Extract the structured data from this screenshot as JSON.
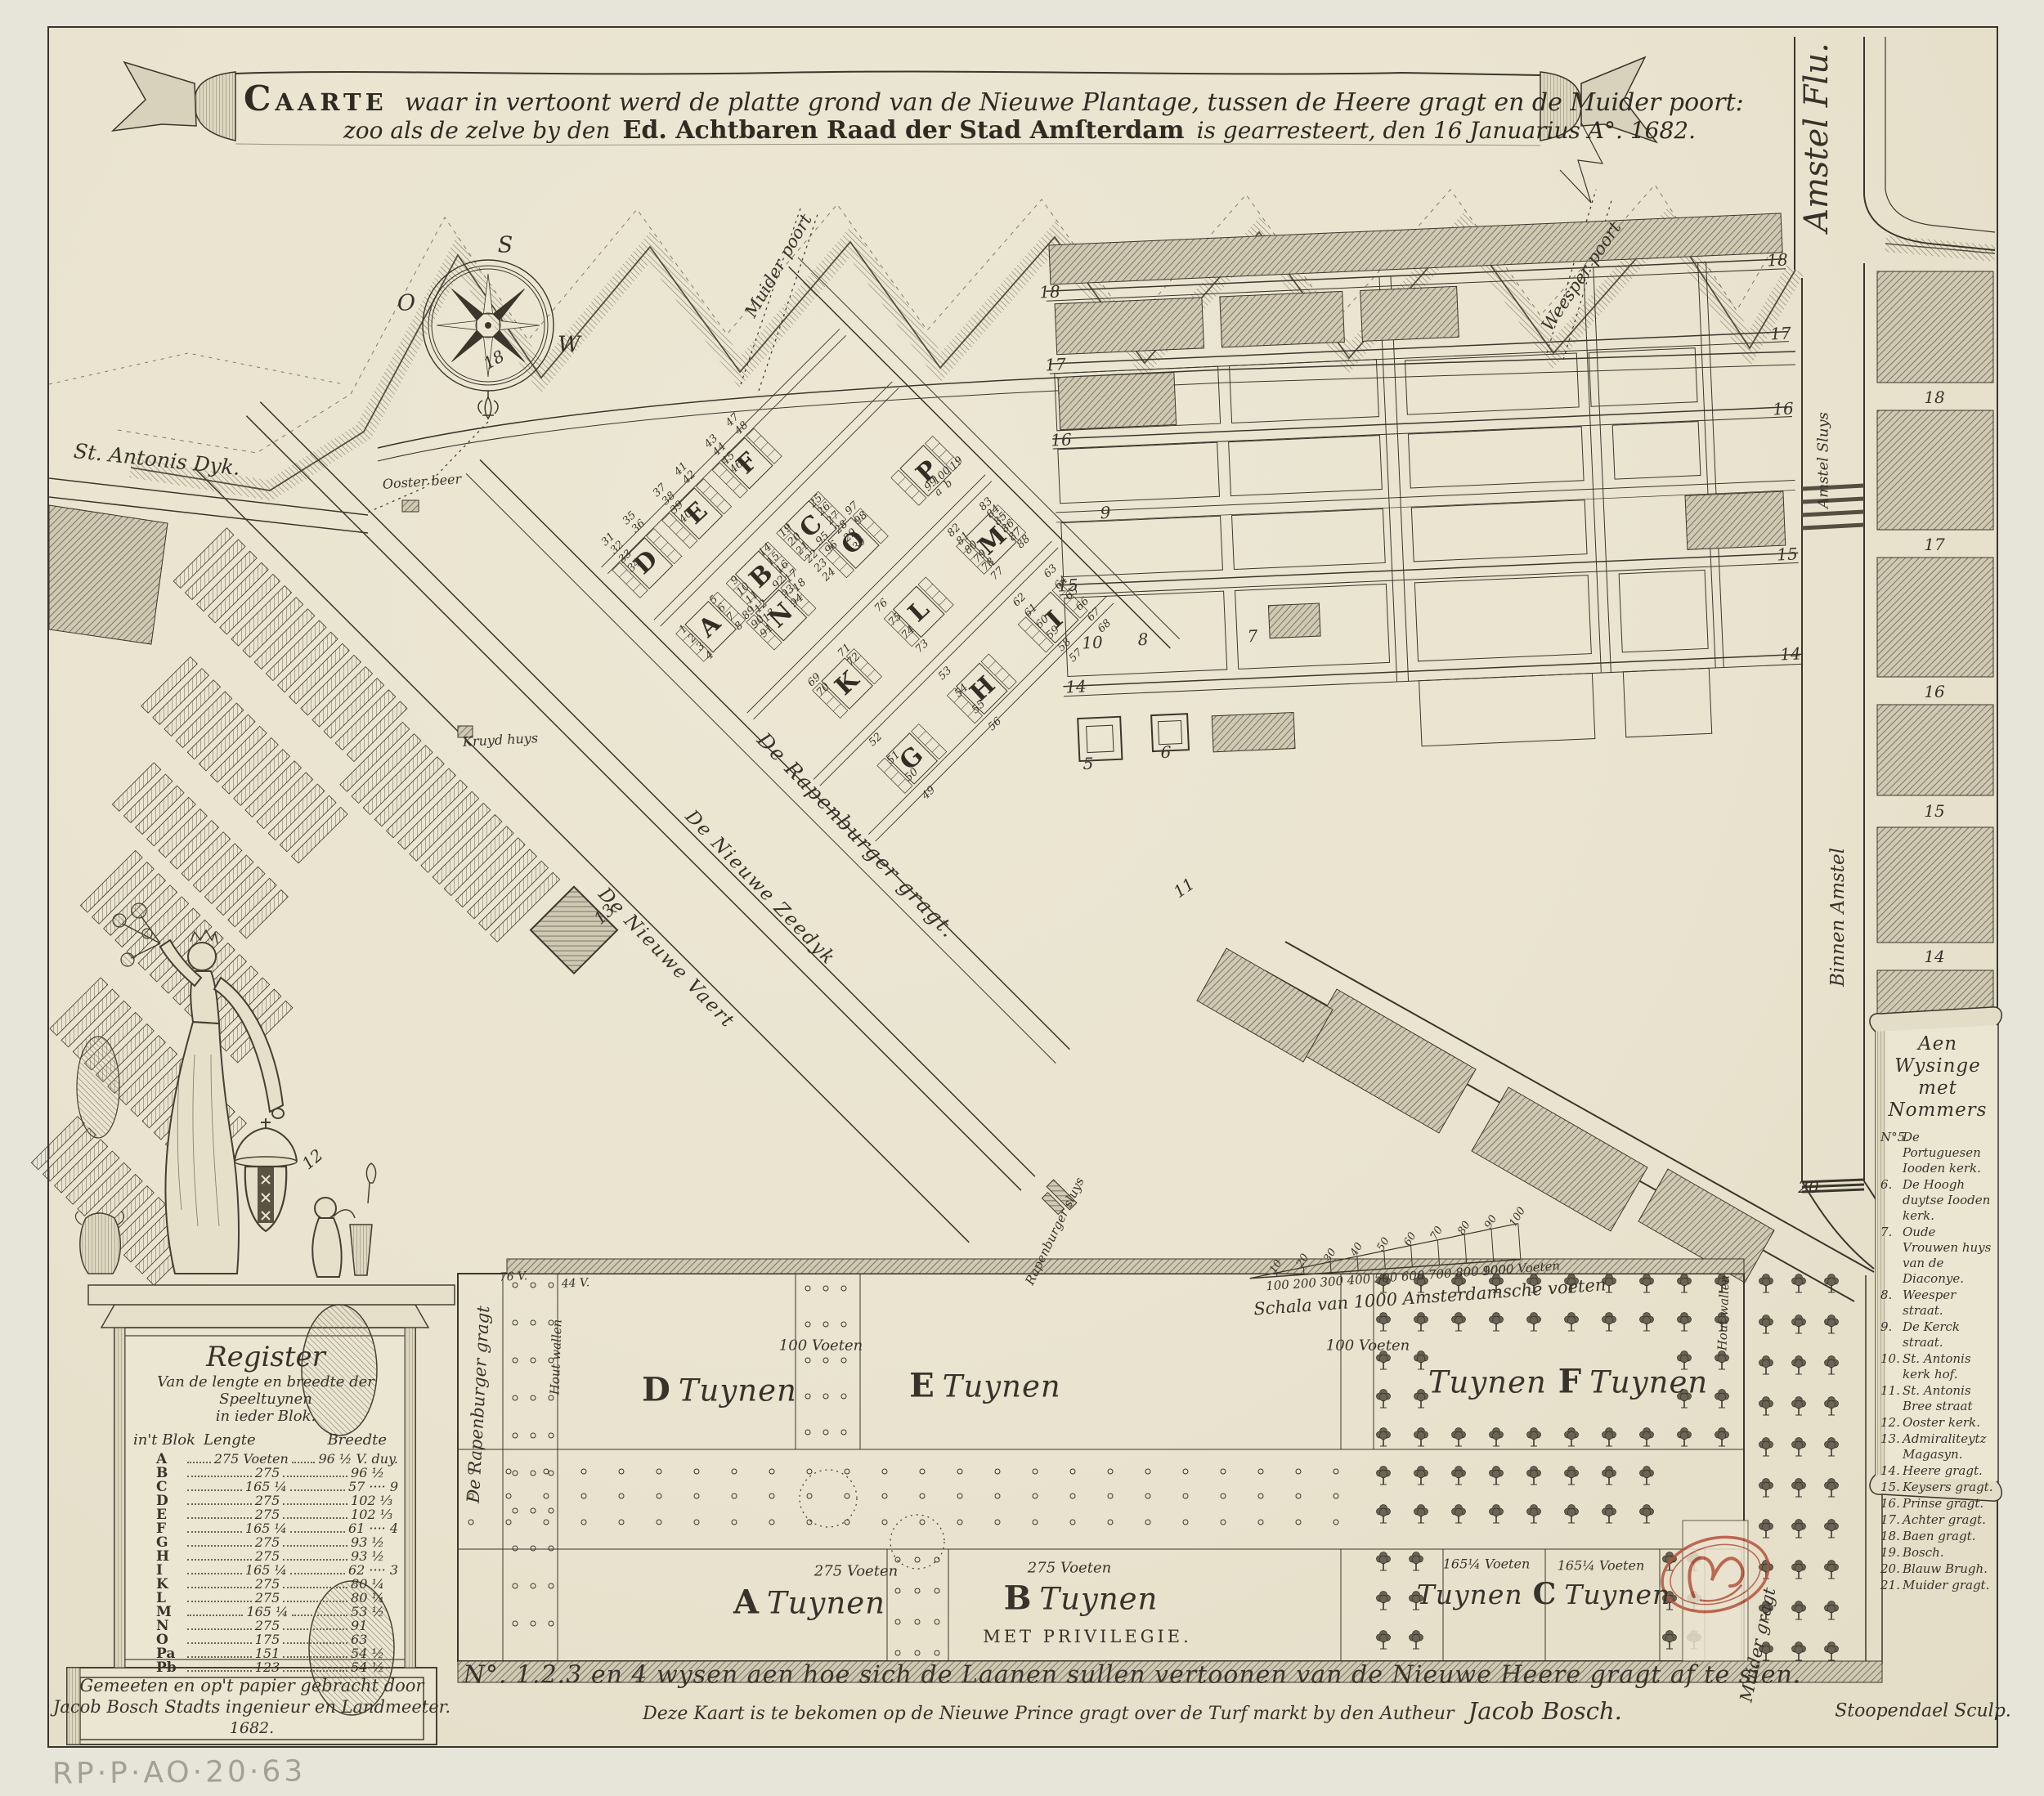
{
  "banner": {
    "l1a": "Caarte",
    "l1b": "waar in vertoont werd de platte grond van de Nieuwe Plantage, tussen de Heere gragt en de Muider poort:",
    "l2a": "zoo als de zelve by den",
    "l2b": "Ed. Achtbaren Raad der Stad Amſterdam",
    "l2c": "is gearresteert, den 16 Januarius A°. 1682."
  },
  "compass": {
    "s": "S",
    "o": "O",
    "w": "W"
  },
  "labels": {
    "amstel_flu": "Amstel Flu.",
    "st_antonis_dyk": "St. Antonis Dyk.",
    "ooster_beer": "Ooster beer",
    "muider_poort": "Muider poort",
    "weesper_poort": "Weesper poort",
    "amstel_sluys": "Amstel Sluys",
    "binnen_amstel": "Binnen Amstel",
    "kruyd_huys": "Kruyd huys",
    "rapenburger_gragt": "De Rapenburger gragt.",
    "nieuwe_zeedyk": "De Nieuwe Zeedyk",
    "nieuwe_vaert": "De Nieuwe Vaert",
    "rapenburger_sluys": "Rapenburger sluys",
    "rapenburger_vert": "De Rapenburger gragt",
    "muider_gragt": "Muider gragt",
    "hout_wallen_left": "Hout wallen",
    "hout_wallen_right": "Hout wallen"
  },
  "gardens": {
    "v100a": "100 Voeten",
    "v100b": "100 Voeten",
    "v275a": "275 Voeten",
    "v275b": "275 Voeten",
    "v165a": "165¼ Voeten",
    "v165b": "165¼ Voeten",
    "v76": "76 V.",
    "v44": "44 V.",
    "d_l": "D",
    "d_w": "Tuynen",
    "e_l": "E",
    "e_w": "Tuynen",
    "f_pre": "Tuynen",
    "f_l": "F",
    "f_w": "Tuynen",
    "a_l": "A",
    "a_w": "Tuynen",
    "b_l": "B",
    "b_w": "Tuynen",
    "privilege": "MET PRIVILEGIE.",
    "c_pre": "Tuynen",
    "c_l": "C",
    "c_w": "Tuynen"
  },
  "scalebar": {
    "caption": "Schala van 1000 Amsterdamsche voeten",
    "bottom": [
      "100",
      "200",
      "300",
      "400",
      "500",
      "600",
      "700",
      "800",
      "900",
      "1000 Voeten"
    ],
    "top": [
      "10",
      "20",
      "30",
      "40",
      "50",
      "60",
      "70",
      "80",
      "90",
      "100"
    ]
  },
  "map": {
    "block_letters": [
      [
        "A",
        868,
        766
      ],
      [
        "B",
        931,
        705
      ],
      [
        "C",
        992,
        644
      ],
      [
        "D",
        790,
        688
      ],
      [
        "E",
        852,
        628
      ],
      [
        "F",
        914,
        567
      ],
      [
        "G",
        1115,
        928
      ],
      [
        "H",
        1202,
        843
      ],
      [
        "I",
        1290,
        758
      ],
      [
        "K",
        1036,
        836
      ],
      [
        "L",
        1124,
        748
      ],
      [
        "M",
        1214,
        662
      ],
      [
        "N",
        955,
        753
      ],
      [
        "O",
        1044,
        664
      ],
      [
        "P",
        1134,
        577
      ]
    ],
    "ref_numbers": [
      [
        "18",
        1284,
        357,
        -3
      ],
      [
        "17",
        1291,
        446,
        -3
      ],
      [
        "16",
        1298,
        538,
        -3
      ],
      [
        "15",
        1306,
        716,
        -3
      ],
      [
        "14",
        1316,
        840,
        -3
      ],
      [
        "18",
        2174,
        318,
        -3
      ],
      [
        "17",
        2178,
        408,
        -3
      ],
      [
        "16",
        2181,
        500,
        -3
      ],
      [
        "15",
        2186,
        678,
        -3
      ],
      [
        "14",
        2190,
        800,
        -3
      ],
      [
        "18",
        2366,
        486,
        0
      ],
      [
        "17",
        2366,
        666,
        0
      ],
      [
        "16",
        2366,
        846,
        0
      ],
      [
        "15",
        2366,
        992,
        0
      ],
      [
        "14",
        2366,
        1170,
        0
      ],
      [
        "9",
        1352,
        627,
        -3
      ],
      [
        "10",
        1336,
        786,
        -3
      ],
      [
        "8",
        1398,
        782,
        -3
      ],
      [
        "7",
        1532,
        778,
        -3
      ],
      [
        "11",
        1448,
        1086,
        -35
      ],
      [
        "12",
        382,
        1418,
        -40
      ],
      [
        "13",
        739,
        1118,
        -42
      ],
      [
        "5",
        1331,
        934,
        0
      ],
      [
        "6",
        1426,
        920,
        0
      ],
      [
        "20",
        2212,
        1452,
        0
      ],
      [
        "18",
        604,
        440,
        -30
      ]
    ],
    "plot_numbers": [
      [
        "83",
        1206,
        617
      ],
      [
        "84",
        1215,
        626
      ],
      [
        "85",
        1224,
        635
      ],
      [
        "86",
        1233,
        644
      ],
      [
        "87",
        1242,
        654
      ],
      [
        "88",
        1252,
        663
      ],
      [
        "82",
        1167,
        649
      ],
      [
        "81",
        1178,
        659
      ],
      [
        "80",
        1188,
        670
      ],
      [
        "79",
        1199,
        681
      ],
      [
        "78",
        1209,
        691
      ],
      [
        "77",
        1220,
        702
      ],
      [
        "63",
        1285,
        699
      ],
      [
        "64",
        1298,
        713
      ],
      [
        "65",
        1311,
        726
      ],
      [
        "66",
        1324,
        739
      ],
      [
        "67",
        1338,
        752
      ],
      [
        "68",
        1351,
        766
      ],
      [
        "62",
        1247,
        734
      ],
      [
        "61",
        1261,
        747
      ],
      [
        "60",
        1275,
        761
      ],
      [
        "59",
        1288,
        774
      ],
      [
        "58",
        1302,
        789
      ],
      [
        "57",
        1316,
        802
      ],
      [
        "52",
        1071,
        905
      ],
      [
        "51",
        1093,
        927
      ],
      [
        "50",
        1115,
        948
      ],
      [
        "49",
        1136,
        970
      ],
      [
        "53",
        1156,
        824
      ],
      [
        "54",
        1176,
        845
      ],
      [
        "55",
        1197,
        865
      ],
      [
        "56",
        1217,
        886
      ],
      [
        "76",
        1078,
        741
      ],
      [
        "75",
        1095,
        758
      ],
      [
        "74",
        1111,
        774
      ],
      [
        "73",
        1128,
        791
      ],
      [
        "99",
        1139,
        593
      ],
      [
        "100",
        1152,
        582
      ],
      [
        "a",
        1148,
        602
      ],
      [
        "b",
        1160,
        592
      ],
      [
        "19",
        1170,
        567
      ],
      [
        "1",
        836,
        770
      ],
      [
        "2",
        847,
        781
      ],
      [
        "3",
        857,
        791
      ],
      [
        "4",
        868,
        802
      ],
      [
        "5",
        873,
        734
      ],
      [
        "6",
        883,
        744
      ],
      [
        "7",
        894,
        755
      ],
      [
        "8",
        904,
        766
      ],
      [
        "9",
        899,
        710
      ],
      [
        "10",
        909,
        721
      ],
      [
        "11",
        920,
        731
      ],
      [
        "12",
        931,
        742
      ],
      [
        "13",
        941,
        753
      ],
      [
        "14",
        936,
        673
      ],
      [
        "15",
        946,
        684
      ],
      [
        "16",
        957,
        694
      ],
      [
        "17",
        968,
        705
      ],
      [
        "18",
        978,
        716
      ],
      [
        "19",
        961,
        649
      ],
      [
        "20",
        972,
        660
      ],
      [
        "21",
        982,
        671
      ],
      [
        "22",
        993,
        681
      ],
      [
        "23",
        1004,
        692
      ],
      [
        "24",
        1014,
        703
      ],
      [
        "25",
        998,
        613
      ],
      [
        "26",
        1008,
        623
      ],
      [
        "27",
        1019,
        634
      ],
      [
        "28",
        1029,
        645
      ],
      [
        "29",
        1040,
        655
      ],
      [
        "30",
        1051,
        666
      ],
      [
        "31",
        744,
        660
      ],
      [
        "32",
        755,
        670
      ],
      [
        "33",
        765,
        681
      ],
      [
        "34",
        776,
        692
      ],
      [
        "35",
        770,
        634
      ],
      [
        "36",
        781,
        644
      ],
      [
        "37",
        807,
        600
      ],
      [
        "38",
        818,
        610
      ],
      [
        "39",
        828,
        621
      ],
      [
        "40",
        839,
        632
      ],
      [
        "41",
        833,
        574
      ],
      [
        "42",
        843,
        584
      ],
      [
        "43",
        870,
        540
      ],
      [
        "44",
        880,
        550
      ],
      [
        "45",
        891,
        561
      ],
      [
        "46",
        901,
        571
      ],
      [
        "47",
        896,
        514
      ],
      [
        "48",
        907,
        524
      ],
      [
        "69",
        996,
        832
      ],
      [
        "70",
        1007,
        844
      ],
      [
        "71",
        1033,
        796
      ],
      [
        "72",
        1044,
        807
      ],
      [
        "89",
        916,
        750
      ],
      [
        "90",
        927,
        761
      ],
      [
        "91",
        938,
        772
      ],
      [
        "92",
        953,
        713
      ],
      [
        "93",
        964,
        724
      ],
      [
        "94",
        975,
        735
      ],
      [
        "95",
        1006,
        659
      ],
      [
        "96",
        1017,
        670
      ],
      [
        "97",
        1042,
        622
      ],
      [
        "98",
        1053,
        634
      ]
    ]
  },
  "register": {
    "title": "Register",
    "sub1": "Van de lengte en breedte der Speeltuynen",
    "sub2": "in ieder Blok.",
    "col_blok": "in't Blok",
    "col_lengte": "Lengte",
    "col_breedte": "Breedte",
    "rows": [
      {
        "blok": "A",
        "lengte": "275 Voeten",
        "breedte": "96 ½ V. duy."
      },
      {
        "blok": "B",
        "lengte": "275",
        "breedte": "96 ½"
      },
      {
        "blok": "C",
        "lengte": "165 ¼",
        "breedte": "57 ···· 9"
      },
      {
        "blok": "D",
        "lengte": "275",
        "breedte": "102 ⅓"
      },
      {
        "blok": "E",
        "lengte": "275",
        "breedte": "102 ⅓"
      },
      {
        "blok": "F",
        "lengte": "165 ¼",
        "breedte": "61 ···· 4"
      },
      {
        "blok": "G",
        "lengte": "275",
        "breedte": "93 ½"
      },
      {
        "blok": "H",
        "lengte": "275",
        "breedte": "93 ½"
      },
      {
        "blok": "I",
        "lengte": "165 ¼",
        "breedte": "62 ···· 3"
      },
      {
        "blok": "K",
        "lengte": "275",
        "breedte": "80 ¼"
      },
      {
        "blok": "L",
        "lengte": "275",
        "breedte": "80 ¼"
      },
      {
        "blok": "M",
        "lengte": "165 ¼",
        "breedte": "53 ½"
      },
      {
        "blok": "N",
        "lengte": "275",
        "breedte": "91"
      },
      {
        "blok": "O",
        "lengte": "175",
        "breedte": "63"
      },
      {
        "blok": "Pa",
        "lengte": "151",
        "breedte": "54 ½"
      },
      {
        "blok": "Pb",
        "lengte": "123",
        "breedte": "54 ½"
      }
    ]
  },
  "legend": {
    "title1": "Aen Wysinge",
    "title2": "met Nommers",
    "items": [
      {
        "n": "N°5.",
        "t": "De Portuguesen Iooden kerk."
      },
      {
        "n": "6.",
        "t": "De Hoogh duytse Iooden kerk."
      },
      {
        "n": "7.",
        "t": "Oude Vrouwen huys van de Diaconye."
      },
      {
        "n": "8.",
        "t": "Weesper straat."
      },
      {
        "n": "9.",
        "t": "De Kerck straat."
      },
      {
        "n": "10.",
        "t": "St. Antonis kerk hof."
      },
      {
        "n": "11.",
        "t": "St. Antonis Bree straat"
      },
      {
        "n": "12.",
        "t": "Ooster kerk."
      },
      {
        "n": "13.",
        "t": "Admiraliteytz Magasyn."
      },
      {
        "n": "14.",
        "t": "Heere gragt."
      },
      {
        "n": "15.",
        "t": "Keysers gragt."
      },
      {
        "n": "16.",
        "t": "Prinse gragt."
      },
      {
        "n": "17.",
        "t": "Achter gragt."
      },
      {
        "n": "18.",
        "t": "Baen gragt."
      },
      {
        "n": "19.",
        "t": "Bosch."
      },
      {
        "n": "20.",
        "t": "Blauw Brugh."
      },
      {
        "n": "21.",
        "t": "Muider gragt."
      }
    ]
  },
  "bottom": {
    "line1": "N°. 1.2.3 en 4 wysen aen hoe sich de Laanen sullen vertoonen van de Nieuwe Heere gragt af te sien.",
    "line2a": "Deze Kaart is te bekomen op de Nieuwe Prince gragt over de Turf markt by den Autheur",
    "line2b": "Jacob Bosch.",
    "sculptor": "Stoopendael Sculp."
  },
  "pedestal": {
    "line1": "Gemeeten en op't papier gebracht door",
    "line2": "Jacob Bosch Stadts ingenieur en Landmeeter.",
    "line3": "1682."
  },
  "handwritten": "RP·P·AO·20·63",
  "colors": {
    "paper": "#eae5d1",
    "ink": "#3a342a",
    "stamp": "#b5533a",
    "pencil": "#a5a096"
  }
}
